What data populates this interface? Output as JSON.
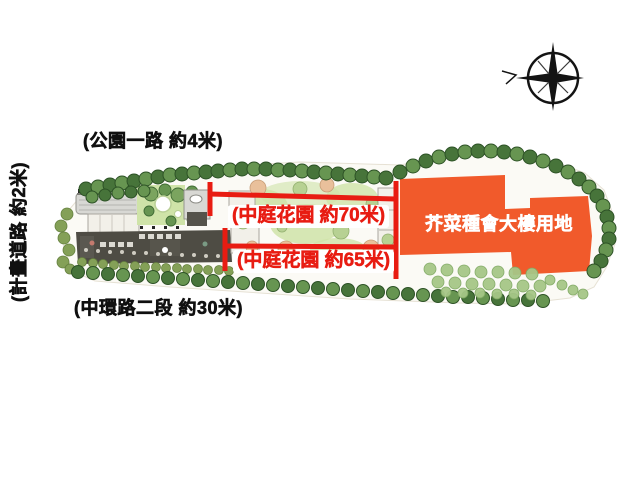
{
  "labels": {
    "park_road": "(公園一路 約4米)",
    "plan_road": "(計畫道路 約2米)",
    "central_road": "(中環路二段 約30米)",
    "courtyard_70": "(中庭花園 約70米)",
    "courtyard_65": "(中庭花園 約65米)",
    "orange_site": "芥菜種會大樓用地"
  },
  "icons": {
    "compass_rose": "compass-rose",
    "trees": "tree-canopy-circles"
  },
  "colors": {
    "dimension-red": "#e81c12",
    "site-orange": "#f15a2b",
    "text-black": "#101010",
    "tree-dark": "#47743a",
    "tree-mid": "#679551",
    "tree-light": "#a6c787",
    "lawn": "#cfe3a8",
    "bldg-light": "#d8d8d4",
    "paving": "#4e4c44",
    "site-bg": "#fbfaf5"
  }
}
